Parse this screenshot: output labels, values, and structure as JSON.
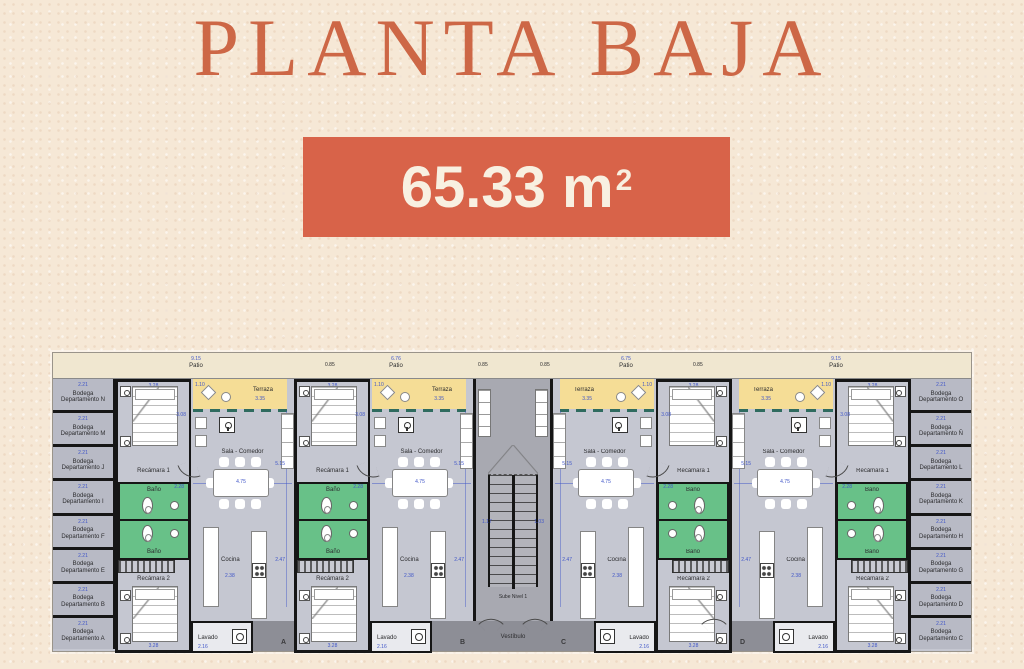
{
  "header": {
    "title": "PLANTA BAJA",
    "area_box": {
      "value": "65.33 m",
      "superscript": "2"
    }
  },
  "colors": {
    "accent_orange": "#d86349",
    "title_orange": "#cd6746",
    "box_text": "#f8f0e1",
    "background_cream": "#f6e8d6",
    "terraza_yellow": "#f5dd96",
    "bath_green": "#68c188",
    "floor_gray": "#c5c7d1",
    "hall_gray": "#a8a9b1",
    "walkway_gray": "#8d8e96",
    "bodega_gray": "#b8bac5",
    "dim_blue": "#4056c8",
    "wall_black": "#161616"
  },
  "plan": {
    "patio_items": [
      {
        "dim": "9.15",
        "label": "Patio"
      },
      {
        "dim": "6.76",
        "label": "Patio"
      },
      {
        "dim": "6.75",
        "label": "Patio"
      },
      {
        "dim": "9.15",
        "label": "Patio"
      }
    ],
    "patio_side_dims": [
      "0.85",
      "0.85",
      "0.85",
      "0.85"
    ],
    "room_labels": {
      "terraza": "Terraza",
      "recamara1": "Recámara 1",
      "recamara2": "Recámara 2",
      "bano": "Baño",
      "sala": "Sala - Comedor",
      "cocina": "Cocina",
      "lavado": "Lavado"
    },
    "dims": {
      "terraza_w": "3.35",
      "terraza_h": "1.10",
      "rec1_w": "3.28",
      "rec1_h": "3.08",
      "sala_h": "5.15",
      "table_w": "4.75",
      "bano_w": "2.28",
      "cocina_h": "2.47",
      "cocina_w": "2.38",
      "rec2_w": "3.28",
      "lavado_w": "2.16",
      "bodega_w": "2.21"
    },
    "apartments": [
      {
        "letter": "A",
        "mirrored": false
      },
      {
        "letter": "B",
        "mirrored": false
      },
      {
        "letter": "C",
        "mirrored": true
      },
      {
        "letter": "D",
        "mirrored": true
      }
    ],
    "bodegas_left": [
      "Bodega Departamento N",
      "Bodega Departamento M",
      "Bodega Departamento J",
      "Bodega Departamento I",
      "Bodega Departamento F",
      "Bodega Departamento E",
      "Bodega Departamento B",
      "Bodega Departamento A"
    ],
    "bodegas_right": [
      "Bodega Departamento O",
      "Bodega Departamento Ñ",
      "Bodega Departamento L",
      "Bodega Departamento K",
      "Bodega Departamento H",
      "Bodega Departamento G",
      "Bodega Departamento D",
      "Bodega Departamento C"
    ],
    "stairs": {
      "sube": "Sube Nivel 1",
      "vestibulo": "Vestíbulo",
      "dim_a": "1.17",
      "dim_b": "1.03"
    }
  }
}
